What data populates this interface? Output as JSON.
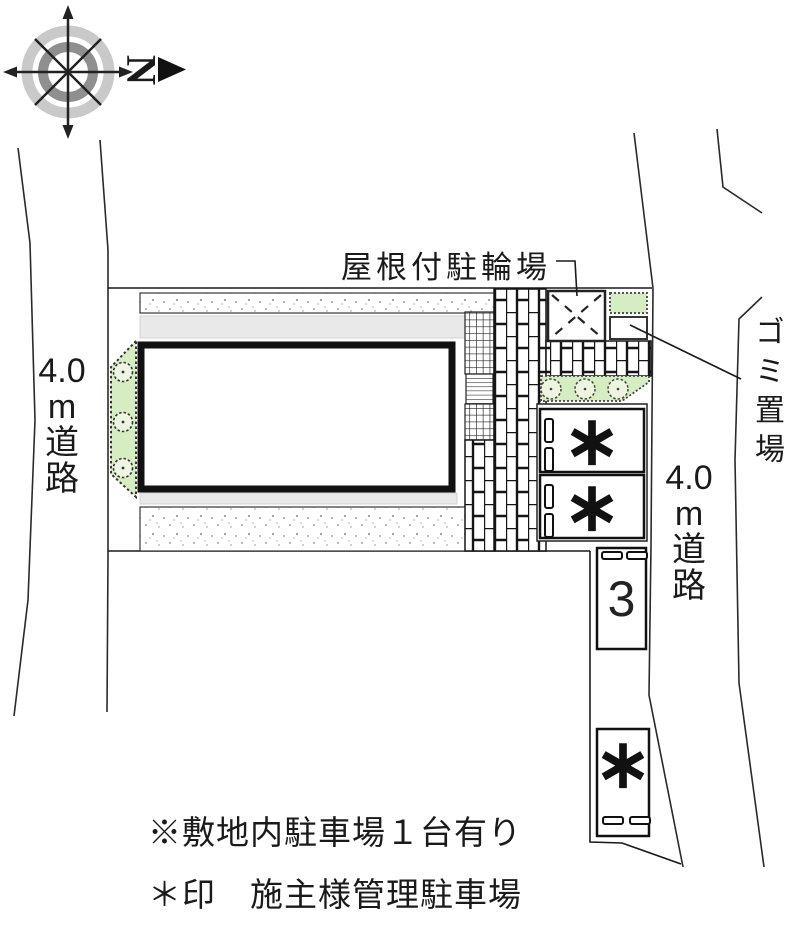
{
  "compass": {
    "north_letter": "N"
  },
  "plan": {
    "bicycle_label": "屋根付駐輪場",
    "garbage_label": "ゴミ置場",
    "left_road": [
      "4.0",
      "m",
      "道",
      "路"
    ],
    "right_road": [
      "4.0",
      "m",
      "道",
      "路"
    ],
    "parking": {
      "space_1_mark": "∗",
      "space_2_mark": "∗",
      "space_3_label": "3",
      "space_4_mark": "∗"
    },
    "notes": [
      "※敷地内駐車場１台有り",
      "＊印　施主様管理駐車場"
    ]
  },
  "colors": {
    "planting_green": "#d6ecc2",
    "bush_fill": "#edf5e1",
    "band_gray": "#e9e9e9",
    "line_black": "#1a1a1a",
    "compass_outer_ring": "#c9c9c9",
    "compass_inner_ring": "#8f8f8f"
  }
}
